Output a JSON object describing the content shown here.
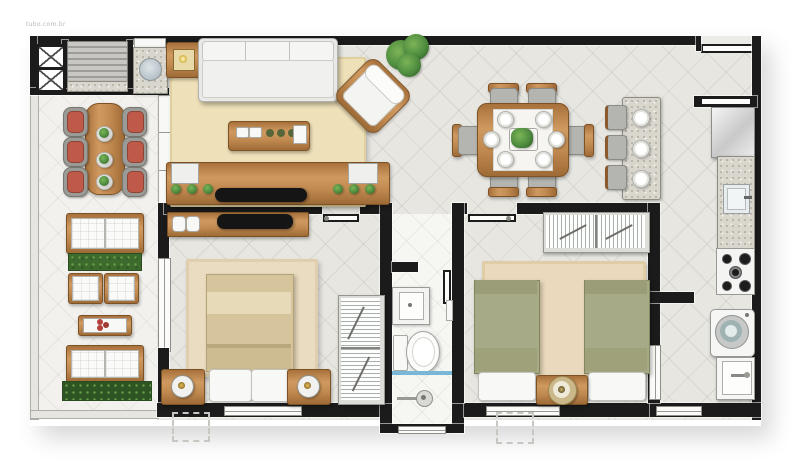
{
  "watermark": "tubo.com.br",
  "plan": {
    "type": "apartment-floor-plan",
    "rooms": [
      {
        "name": "gourmet-balcony",
        "furniture": [
          "hatch-units",
          "barbecue-grill",
          "round-sink-counter",
          "long-table-6-chairs",
          "bench-sofa",
          "planter",
          "two-armchairs",
          "coffee-table-flowers",
          "loveseat",
          "hedge"
        ]
      },
      {
        "name": "living-room",
        "furniture": [
          "lamp-side-table",
          "three-seat-sofa",
          "accent-armchair",
          "fern-plant",
          "coffee-table",
          "tv-console",
          "tv"
        ]
      },
      {
        "name": "dining-room",
        "furniture": [
          "dining-table-6-chairs",
          "buffet-counter-3-stools"
        ]
      },
      {
        "name": "kitchen",
        "furniture": [
          "refrigerator",
          "counter-with-sink",
          "cooktop"
        ]
      },
      {
        "name": "laundry-area",
        "furniture": [
          "washing-machine",
          "laundry-tank"
        ]
      },
      {
        "name": "bedroom-1",
        "furniture": [
          "dresser-with-tv",
          "double-bed",
          "two-nightstand-lamps",
          "sliding-wardrobe",
          "rug"
        ]
      },
      {
        "name": "bathroom",
        "furniture": [
          "vanity-sink",
          "toilet",
          "shower-box"
        ]
      },
      {
        "name": "bedroom-2",
        "furniture": [
          "sliding-wardrobe",
          "single-bed-left",
          "single-bed-right",
          "nightstand-lamp",
          "rug"
        ]
      }
    ]
  },
  "colors": {
    "wall": "#1b1b1b",
    "floor_tile": "#e7e6e1",
    "balcony_tile": "#f2f1ed",
    "bathroom_tile": "#f6f6f3",
    "wood": "#c08950",
    "rug_living": "#eee0b8",
    "rug_bedroom": "#eadcc0",
    "bed1_blanket": "#d6c49c",
    "bed2_blanket": "#a7aa87",
    "chair_cushion_red": "#bf5a4a",
    "plant_green": "#4e8c3f",
    "shower_glass": "#79b7d6",
    "white_fabric": "#f8f8f7",
    "granite": "#d9d6ce"
  }
}
